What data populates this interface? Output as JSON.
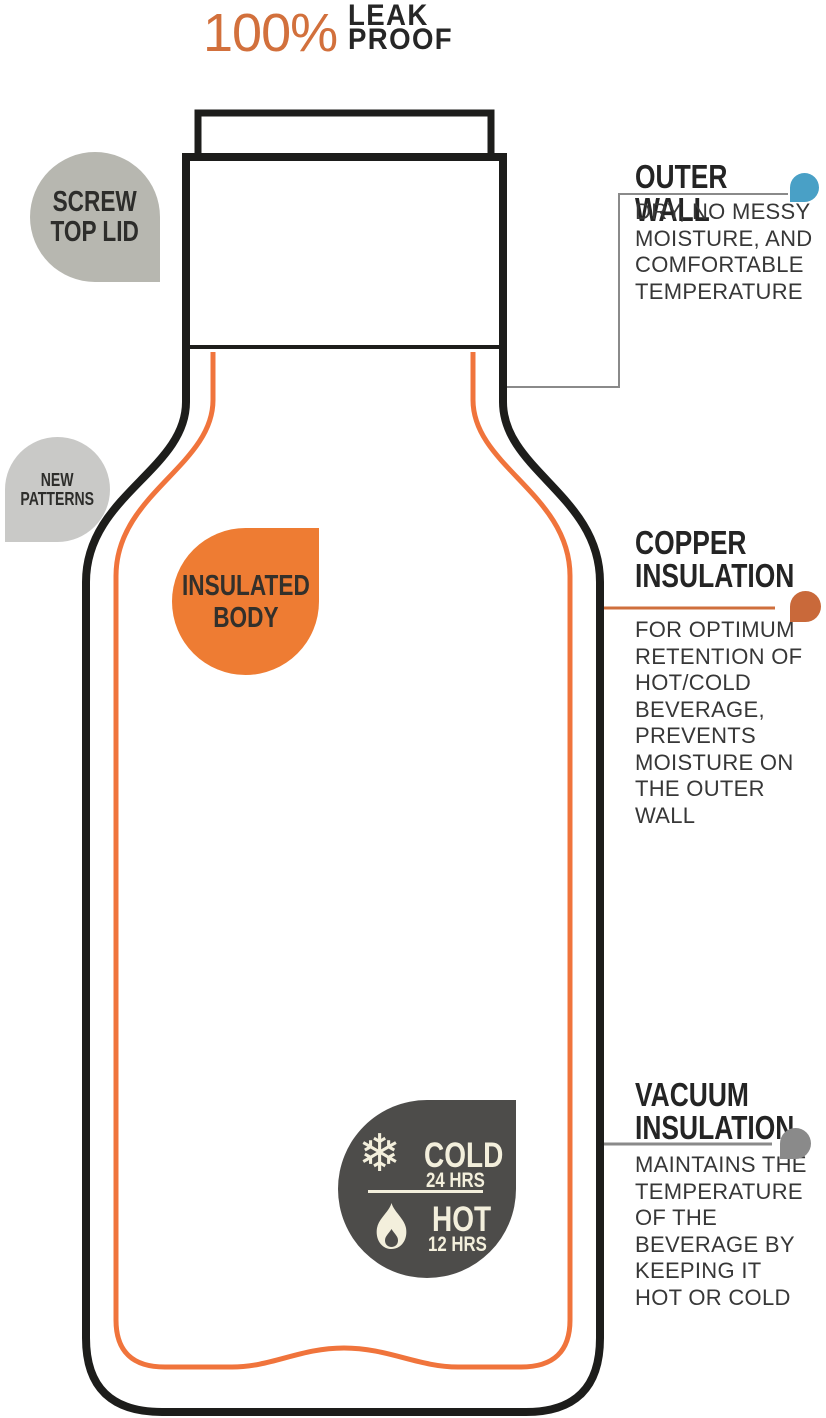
{
  "title": {
    "percent": "100%",
    "wordmark": "LEAK\nPROOF"
  },
  "badges": {
    "screw_top_lid": "SCREW\nTOP LID",
    "new_patterns": "NEW\nPATTERNS",
    "insulated_body": "INSULATED\nBODY"
  },
  "retention_badge": {
    "snowflake_glyph": "❄",
    "cold_label": "COLD",
    "cold_duration": "24 HRS",
    "hot_label": "HOT",
    "hot_duration": "12 HRS"
  },
  "callouts": {
    "outer_wall": {
      "heading": "OUTER WALL",
      "body": "DRY, NO MESSY\nMOISTURE, AND\nCOMFORTABLE\nTEMPERATURE"
    },
    "copper_insulation": {
      "heading": "COPPER\nINSULATION",
      "body": "FOR OPTIMUM\nRETENTION OF\nHOT/COLD\nBEVERAGE,\nPREVENTS\nMOISTURE ON\nTHE OUTER\nWALL"
    },
    "vacuum_insulation": {
      "heading": "VACUUM\nINSULATION",
      "body": "MAINTAINS THE\nTEMPERATURE\nOF THE\nBEVERAGE BY\nKEEPING IT\nHOT OR COLD"
    }
  },
  "colors": {
    "ink": "#1d1d1b",
    "line_orange": "#f0743c",
    "badge_orange": "#ee7c33",
    "title_orange": "#d2703c",
    "copper_accent": "#c9693a",
    "blue_accent": "#49a0c6",
    "charcoal": "#4d4c4a",
    "cream": "#f3efdc",
    "gray_badge": "#b7b7b0",
    "light_gray_badge": "#c9c9c7",
    "connector_gray": "#8a8a8a"
  }
}
